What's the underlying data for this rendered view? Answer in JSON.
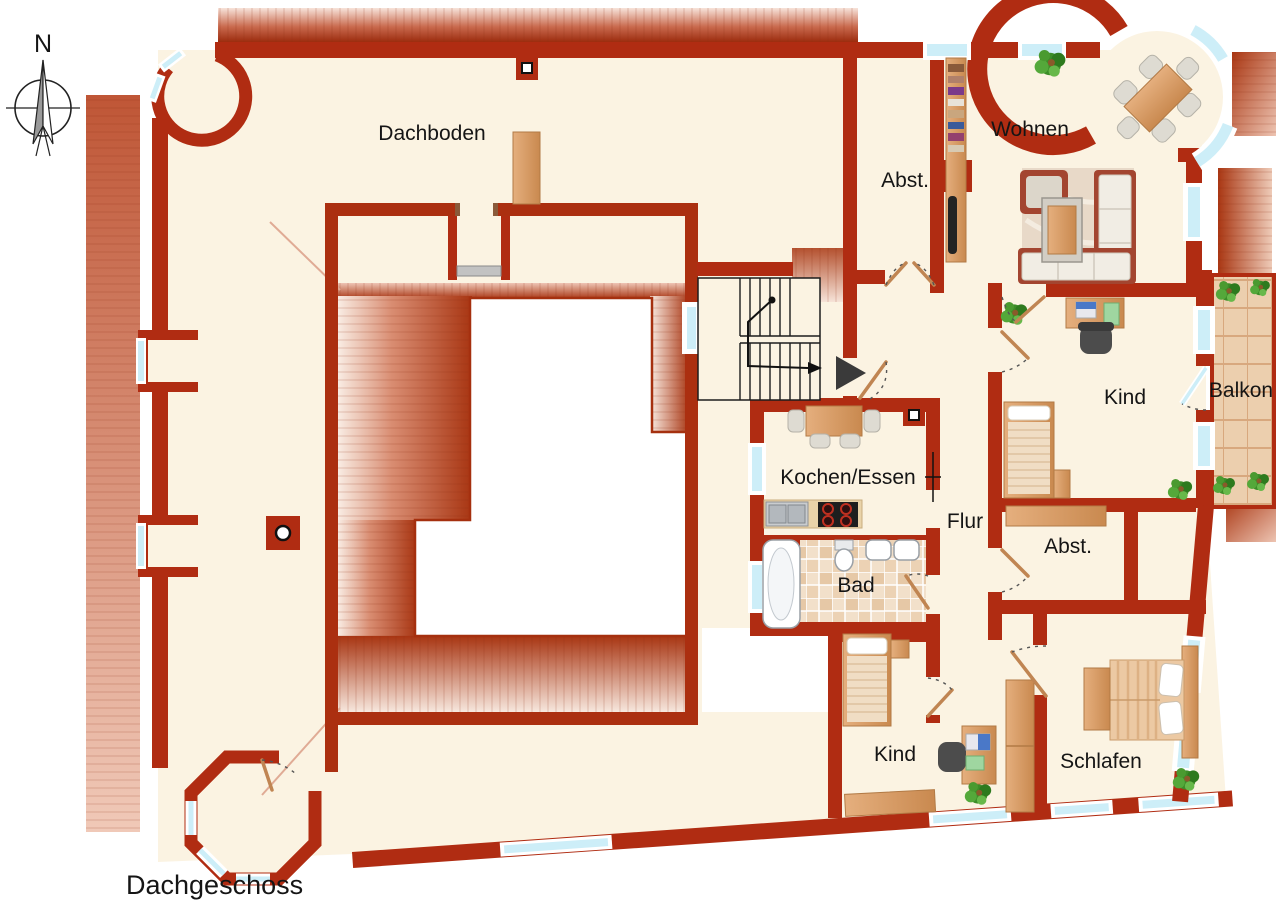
{
  "floor_label": "Dachgeschoss",
  "compass": {
    "north": "N"
  },
  "rooms": {
    "dachboden": "Dachboden",
    "abstellraum_top": "Abst.",
    "wohnen": "Wohnen",
    "kind_top": "Kind",
    "balkon": "Balkon",
    "kochen_essen": "Kochen/Essen",
    "flur": "Flur",
    "abstellraum_mid": "Abst.",
    "bad": "Bad",
    "kind_bottom": "Kind",
    "schlafen": "Schlafen"
  },
  "colors": {
    "wall": "#b02c12",
    "floor": "#fbf3e2",
    "roof_dark": "#a93612",
    "roof_light": "#f6ddd2",
    "window_glass": "#cdeef8",
    "wood": "#d79a63",
    "balcony_tile": "#eccfae",
    "bath_tile": "#e9cfb2",
    "plant_green": "#3c8d28",
    "courtyard_white": "#ffffff",
    "label_text": "#151515"
  }
}
